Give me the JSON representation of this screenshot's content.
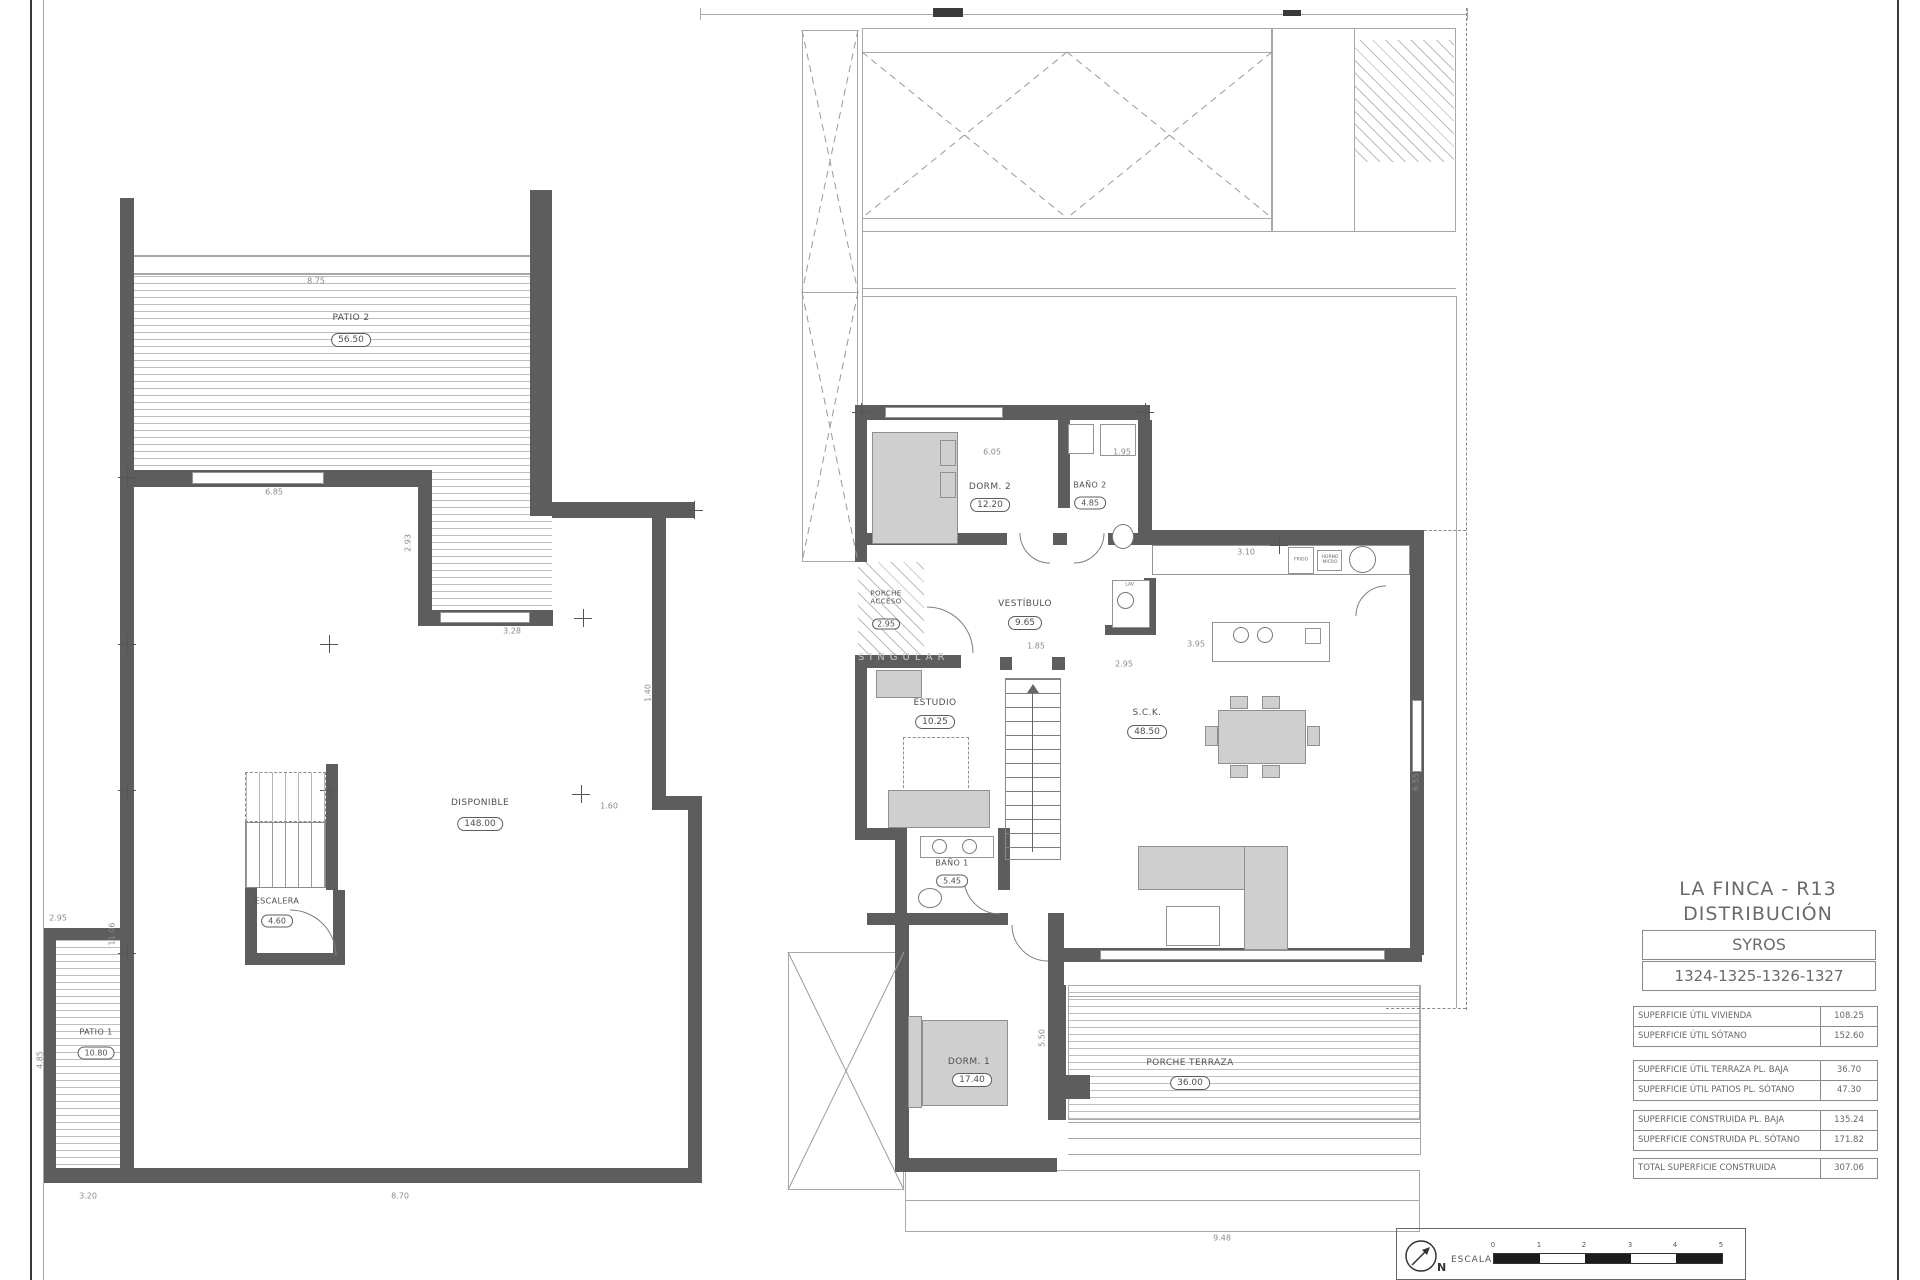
{
  "title_block": {
    "project": "LA FINCA - R13",
    "subtitle": "DISTRIBUCIÓN",
    "model": "SYROS",
    "units": "1324-1325-1326-1327"
  },
  "area_table": {
    "rows": [
      {
        "label": "SUPERFICIE ÚTIL VIVIENDA",
        "value": "108.25"
      },
      {
        "label": "SUPERFICIE ÚTIL SÓTANO",
        "value": "152.60"
      },
      {
        "label": "SUPERFICIE ÚTIL TERRAZA PL. BAJA",
        "value": "36.70"
      },
      {
        "label": "SUPERFICIE ÚTIL PATIOS PL. SÓTANO",
        "value": "47.30"
      },
      {
        "label": "SUPERFICIE CONSTRUIDA PL. BAJA",
        "value": "135.24"
      },
      {
        "label": "SUPERFICIE CONSTRUIDA PL. SÓTANO",
        "value": "171.82"
      },
      {
        "label": "TOTAL SUPERFICIE CONSTRUIDA",
        "value": "307.06"
      }
    ]
  },
  "scale_bar": {
    "escala_label": "ESCALA",
    "north_label": "N",
    "ticks": [
      "0",
      "1",
      "2",
      "3",
      "4",
      "5"
    ]
  },
  "basement": {
    "rooms": [
      {
        "name": "PATIO 2",
        "area": "56.50"
      },
      {
        "name": "DISPONIBLE",
        "area": "148.00"
      },
      {
        "name": "ESCALERA",
        "area": "4.60"
      },
      {
        "name": "PATIO 1",
        "area": "10.80"
      }
    ]
  },
  "ground": {
    "rooms": [
      {
        "name": "DORM. 2",
        "area": "12.20"
      },
      {
        "name": "BAÑO 2",
        "area": "4.85"
      },
      {
        "name": "VESTÍBULO",
        "area": "9.65"
      },
      {
        "name": "ESTUDIO",
        "area": "10.25"
      },
      {
        "name": "S.C.K.",
        "area": "48.50"
      },
      {
        "name": "BAÑO 1",
        "area": "5.45"
      },
      {
        "name": "DORM. 1",
        "area": "17.40"
      },
      {
        "name": "PORCHE TERRAZA",
        "area": "36.00"
      },
      {
        "name": "PORCHE ACCESO",
        "area": "2.95"
      }
    ],
    "kitchen": {
      "fridge": "FRIGO",
      "oven": "HORNO MICRO",
      "washer": "LAV."
    }
  },
  "watermark": "SINGULAR",
  "dims": {
    "basement": [
      "8.75",
      "6.85",
      "3.28",
      "1.60",
      "1.40",
      "11.06",
      "2.95",
      "4.85",
      "3.20",
      "8.70",
      "2.93"
    ],
    "ground": [
      "6.05",
      "1.95",
      "3.10",
      "2.95",
      "1.85",
      "6.55",
      "5.50",
      "9.48",
      "3.95"
    ]
  }
}
